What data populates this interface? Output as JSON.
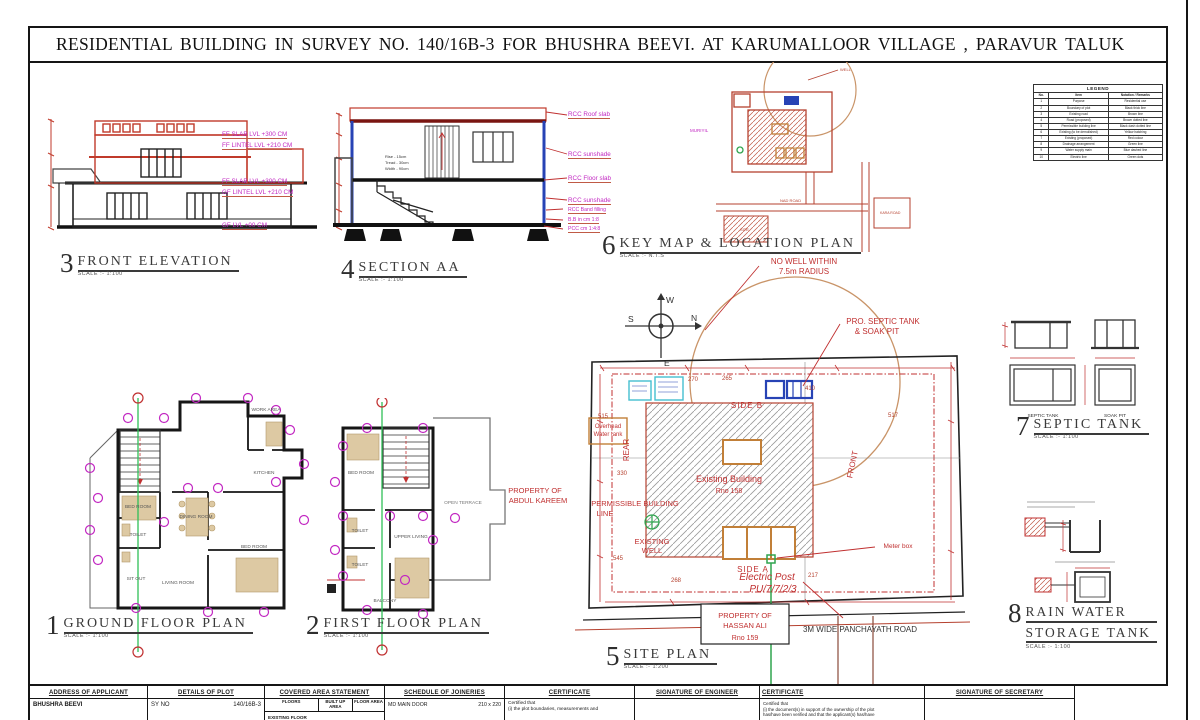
{
  "sheet": {
    "title": "RESIDENTIAL BUILDING  IN  SURVEY NO. 140/16B-3  FOR BHUSHRA BEEVI.  AT KARUMALLOOR VILLAGE ,  PARAVUR TALUK"
  },
  "drawings": {
    "front_elevation": {
      "num": "3",
      "title": "FRONT  ELEVATION",
      "scale": "SCALE :- 1:100",
      "levels": [
        "FF SLAB LVL +300 CM",
        "FF LINTEL LVL +210 CM",
        "FF SLAB LVL +300 CM",
        "GF LINTEL LVL +210 CM",
        "GF LVL +00 CM"
      ]
    },
    "section_aa": {
      "num": "4",
      "title": "SECTION AA",
      "scale": "SCALE :- 1:100",
      "callouts": [
        "RCC Roof slab",
        "RCC sunshade",
        "RCC Floor slab",
        "RCC sunshade",
        "RCC Band filling",
        "B.B in cm 1:8",
        "PCC cm 1:4:8"
      ],
      "stair_note": [
        "Rise - 15cm",
        "Tread - 30cm",
        "Width - 90cm"
      ]
    },
    "key_map": {
      "num": "6",
      "title": "KEY MAP & LOCATION PLAN",
      "scale": "SCALE :- N.T.S",
      "labels": {
        "muriyil": "MURIYIL",
        "road": "NAD ROAD",
        "site": "SITE",
        "well": "WELL",
        "kara_road": "KARA ROAD"
      }
    },
    "ground_floor": {
      "num": "1",
      "title": "GROUND  FLOOR  PLAN",
      "scale": "SCALE :- 1:100",
      "rooms": [
        "BED ROOM",
        "TOILET",
        "SIT OUT",
        "DINING ROOM",
        "LIVING ROOM",
        "BED ROOM",
        "KITCHEN",
        "WORK AREA"
      ]
    },
    "first_floor": {
      "num": "2",
      "title": "FIRST  FLOOR  PLAN",
      "scale": "SCALE :- 1:100",
      "rooms": [
        "BED ROOM",
        "TOILET",
        "TOILET",
        "UPPER LIVING",
        "BALCONY",
        "OPEN TERRACE"
      ]
    },
    "site_plan": {
      "num": "5",
      "title": "SITE PLAN",
      "scale": "SCALE :- 1:200",
      "labels": {
        "no_well_1": "NO WELL WITHIN",
        "no_well_2": "7.5m RADIUS",
        "septic_1": "PRO. SEPTIC TANK",
        "septic_2": "& SOAK PIT",
        "side_b": "SIDE B",
        "side_a": "SIDE A",
        "rear": "REAR",
        "front": "FRONT",
        "existing_building": "Existing Building",
        "existing_building_no": "Rno 158",
        "permissible_1": "PERMISSIBLE BUILDING",
        "permissible_2": "LINE",
        "existing_well_1": "EXISTING",
        "existing_well_2": "WELL",
        "overhead_1": "Overhead",
        "overhead_2": "Water tank",
        "property_left_1": "PROPERTY OF",
        "property_left_2": "ABDUL KAREEM",
        "meter_box": "Meter box",
        "electric_post": "Electric Post",
        "electric_post_no": "PU/7/7/2/3",
        "property_box_1": "PROPERTY OF",
        "property_box_2": "HASSAN ALI",
        "property_box_3": "Rno 159",
        "road": "3M WIDE PANCHAYATH ROAD"
      },
      "dims": {
        "d270": "270",
        "d265": "265",
        "d410": "410",
        "d515": "515",
        "d517": "517",
        "d330": "330",
        "d545": "545",
        "d268": "268",
        "d217": "217"
      }
    },
    "septic_tank": {
      "num": "7",
      "title": "SEPTIC TANK",
      "scale": "SCALE :- 1:100",
      "captions": [
        "SEPTIC TANK",
        "SOAK PIT"
      ]
    },
    "rain_water": {
      "num": "8",
      "title_1": "RAIN WATER",
      "title_2": "STORAGE TANK",
      "scale": "SCALE :- 1:100"
    }
  },
  "compass": {
    "n": "N",
    "s": "S",
    "e": "E",
    "w": "W"
  },
  "legend": {
    "title": "LEGEND",
    "headers": [
      "No.",
      "Item",
      "Notation / Remarks"
    ],
    "rows": [
      [
        "1",
        "Purpose",
        "Residential use"
      ],
      [
        "2",
        "Boundary of plot",
        "Black thick line"
      ],
      [
        "3",
        "Existing road",
        "Brown line"
      ],
      [
        "4",
        "Road (proposed)",
        "Brown dotted line"
      ],
      [
        "5",
        "Permissible building line",
        "Black dash dotted line"
      ],
      [
        "6",
        "Existing (to be demolished)",
        "Yellow hatching"
      ],
      [
        "7",
        "Existing (proposed)",
        "Red colour"
      ],
      [
        "8",
        "Drainage arrangement",
        "Green line"
      ],
      [
        "9",
        "Water supply main",
        "Blue dashed line"
      ],
      [
        "10",
        "Electric line",
        "Green dots"
      ]
    ]
  },
  "title_block": {
    "col1": {
      "header": "ADDRESS OF APPLICANT",
      "content": "BHUSHRA BEEVI"
    },
    "col2": {
      "header": "DETAILS OF PLOT",
      "label": "SY NO",
      "value": "140/16B-3"
    },
    "col3": {
      "header": "COVERED AREA STATEMENT",
      "sub1": "FLOORS",
      "sub2": "BUILT UP AREA",
      "sub3": "FLOOR AREA",
      "row": "EXISTING FLOOR"
    },
    "col4": {
      "header": "SCHEDULE OF JOINERIES",
      "row_label": "MD  MAIN DOOR",
      "row_value": "210 x 220"
    },
    "col5": {
      "header": "CERTIFICATE",
      "line1": "Certified that",
      "line2": "(i) the plot boundaries, measurements and"
    },
    "col6": {
      "header": "SIGNATURE OF ENGINEER"
    },
    "col7": {
      "header": "CERTIFICATE",
      "line1": "Certified that",
      "line2": "(i) the document(s) in support of the ownership of the plot",
      "line3": "has/have been verified and that the applicant(s) has/have"
    },
    "col8": {
      "header": "SIGNATURE OF SECRETARY"
    }
  }
}
